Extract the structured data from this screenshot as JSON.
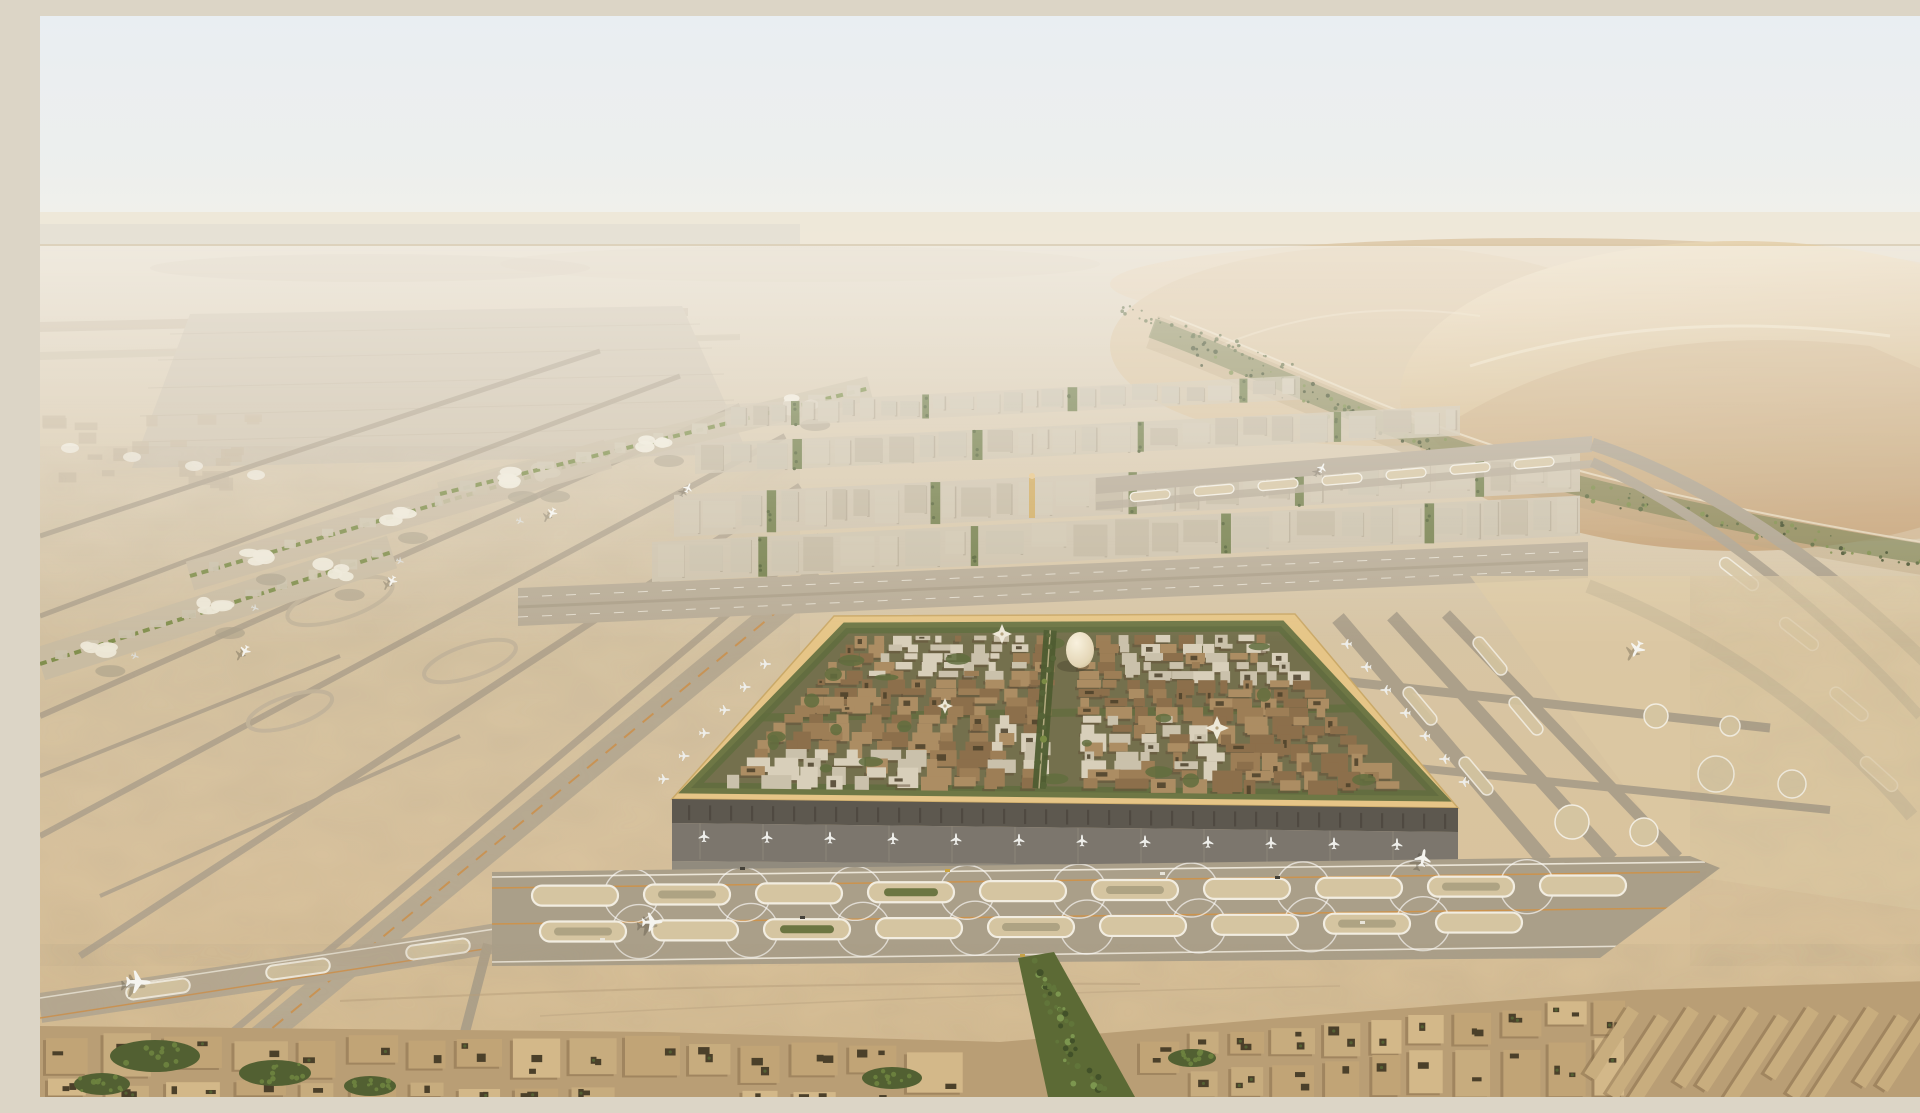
{
  "page": {
    "title": "Desert airport city — aerial masterplan render"
  },
  "scene": {
    "description": "High aerial rendering of a vast airport city in a sand desert: a square terminal district ringed by a golden canopy wall encloses dense mud-toned blocks, garden courtyards, a white egg-shaped landmark dome and green planted spines; parallel runway and taxiway networks spread to the west and east; linear satellite concourses with white canopies stretch toward the far west; tall dunes threaded by a green wadi planting belt rise in the east; a low mud-brick town with tree-filled courtyards fills the foreground below a wide apron band of oval holding pads dotted with taxiing aircraft.",
    "palette": {
      "sky_top": "#e9f0f6",
      "sky_low": "#f6f3ec",
      "haze": "#efe7d8",
      "ground_far": "#d9cdb6",
      "ground_mid": "#d7c4a3",
      "ground_near": "#d6bd93",
      "sand_bright": "#e2cfa9",
      "dune_light": "#ead9b8",
      "dune_mid": "#d3b88e",
      "dune_deep": "#c09a6c",
      "dune_shadow": "#a8875f",
      "wadi_green": "#4f5e31",
      "wadi_dark": "#36421f",
      "veg_light": "#74873f",
      "tax_gray": "#b3a790",
      "tax_light": "#c3b69e",
      "run_gray": "#a99d88",
      "line_white": "#f3efe4",
      "line_orange": "#d08a3c",
      "apron_dark": "#76716a",
      "facade_dark": "#56524a",
      "road_gray": "#8d877c",
      "gold": "#e6c585",
      "gold_deep": "#c9a765",
      "band_gray": "#a79c87",
      "pad_sand": "#d4c4a1",
      "pad_speck": "#8f8a6d",
      "city_mud": "#997a52",
      "city_mud2": "#876a46",
      "city_mud3": "#a9895f",
      "city_shadow": "#5c4832",
      "cream": "#d7cfbb",
      "cream2": "#c9c0ab",
      "square_base": "#6e6b48",
      "square_green": "#5a6838",
      "town_tan": "#c6aa7c",
      "town_roof": "#d2b787",
      "town_shadow": "#7c6140",
      "court_dark": "#433823",
      "egg_hi": "#faf3e1",
      "egg_lo": "#c4b38c",
      "white_canopy": "#eee9da",
      "upper_block": "#cfc5af",
      "upper_block2": "#c2b7a0",
      "upper_base": "#cdc2ac",
      "upper_shadow": "#9a8e77",
      "plane_white": "#eff0ee"
    },
    "landmarks": {
      "egg_dome": "egg-shaped landmark dome",
      "canopy_pavilion": "white fan-canopy pavilion",
      "minaret": "gold minaret tower",
      "gold_wall": "golden perimeter canopy of the terminal square",
      "wadi": "green wadi planting belt between dunes",
      "dunes": "eastern sand dunes",
      "oval_pads": "oval holding pads on the foreground apron band"
    },
    "aircraft": {
      "south_gates": {
        "count": 12
      },
      "west_gates": {
        "count": 6
      },
      "east_gates": {
        "count": 7
      },
      "remote_stands": {
        "count": 4
      },
      "taxiing": [
        {
          "x": 98,
          "y": 966,
          "s": 1.25,
          "r": 92
        },
        {
          "x": 612,
          "y": 906,
          "s": 1.05,
          "r": 88
        },
        {
          "x": 1383,
          "y": 842,
          "s": 0.9,
          "r": 10
        },
        {
          "x": 1597,
          "y": 633,
          "s": 0.85,
          "r": 207
        },
        {
          "x": 512,
          "y": 497,
          "s": 0.55,
          "r": 205
        },
        {
          "x": 352,
          "y": 565,
          "s": 0.55,
          "r": 205
        },
        {
          "x": 205,
          "y": 635,
          "s": 0.6,
          "r": 206
        },
        {
          "x": 648,
          "y": 472,
          "s": 0.5,
          "r": 24
        },
        {
          "x": 1282,
          "y": 452,
          "s": 0.5,
          "r": 24
        }
      ]
    },
    "pad_band": {
      "rows": 2,
      "pads_per_row": [
        10,
        9
      ],
      "pad_fill_pattern": [
        "sand",
        "speck",
        "sand",
        "green",
        "sand",
        "speck",
        "sand",
        "sand",
        "speck",
        "sand"
      ],
      "orange_guidelines": 2
    },
    "upper_district": {
      "rows": 4,
      "green_strip_every": 7
    },
    "square_city": {
      "blocks_u": 21,
      "blocks_v": 17,
      "green_pockets": 20,
      "cream_clusters": 4
    },
    "foreground_town": {
      "left_blocks": 17,
      "right_blocks": 12,
      "slab_rows": 11,
      "tree_clusters": 6
    },
    "vehicles": [
      {
        "x": 700,
        "y": 851,
        "c": "#3c3933"
      },
      {
        "x": 905,
        "y": 853,
        "c": "#c9a23a"
      },
      {
        "x": 1120,
        "y": 856,
        "c": "#e8e5dc"
      },
      {
        "x": 760,
        "y": 900,
        "c": "#3c3933"
      },
      {
        "x": 980,
        "y": 938,
        "c": "#c9a23a"
      },
      {
        "x": 560,
        "y": 922,
        "c": "#e8e5dc"
      },
      {
        "x": 1235,
        "y": 860,
        "c": "#3c3933"
      },
      {
        "x": 1320,
        "y": 905,
        "c": "#e8e5dc"
      }
    ],
    "wadi_speckles": 150
  }
}
